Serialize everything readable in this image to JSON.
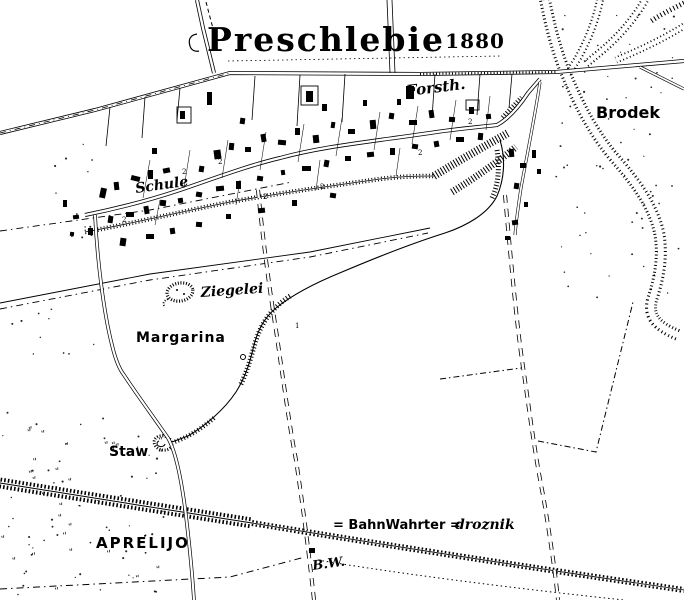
{
  "map": {
    "title": "Preschlebie",
    "year": "- 1880",
    "labels": {
      "forsth": "Forsth.",
      "brodek": "Brodek",
      "schule": "Schule",
      "ziegelei": "Ziegelei",
      "margarina": "Margarina",
      "staw": "Staw",
      "aprelijo": "APRELIJO",
      "bw_abbrev": "B.W."
    },
    "legend": {
      "equals_left": "= BahnWahrter =",
      "term_right": "droznik"
    },
    "colors": {
      "ink": "#000000",
      "paper": "#ffffff"
    },
    "parcel_marks": [
      [
        "2",
        122,
        222
      ],
      [
        "2",
        218,
        164
      ],
      [
        "2",
        263,
        199
      ],
      [
        "2",
        320,
        189
      ],
      [
        "2",
        418,
        155
      ],
      [
        "2",
        468,
        124
      ],
      [
        "2",
        182,
        174
      ],
      [
        "1",
        295,
        328
      ]
    ],
    "buildings": [
      [
        100,
        188,
        6,
        10,
        12
      ],
      [
        114,
        182,
        5,
        8,
        -6
      ],
      [
        131,
        176,
        9,
        5,
        14
      ],
      [
        148,
        170,
        5,
        9,
        0
      ],
      [
        163,
        168,
        7,
        5,
        -12
      ],
      [
        199,
        166,
        5,
        6,
        9
      ],
      [
        214,
        150,
        7,
        9,
        -8
      ],
      [
        229,
        143,
        5,
        7,
        6
      ],
      [
        245,
        147,
        6,
        5,
        0
      ],
      [
        261,
        134,
        5,
        8,
        -10
      ],
      [
        278,
        140,
        8,
        5,
        5
      ],
      [
        295,
        128,
        5,
        7,
        0
      ],
      [
        313,
        135,
        6,
        8,
        -6
      ],
      [
        331,
        122,
        4,
        6,
        8
      ],
      [
        348,
        129,
        7,
        5,
        0
      ],
      [
        370,
        120,
        6,
        9,
        -5
      ],
      [
        389,
        113,
        5,
        6,
        8
      ],
      [
        409,
        120,
        8,
        5,
        0
      ],
      [
        429,
        110,
        5,
        8,
        -8
      ],
      [
        449,
        117,
        6,
        5,
        5
      ],
      [
        469,
        107,
        5,
        7,
        0
      ],
      [
        486,
        114,
        5,
        5,
        -6
      ],
      [
        152,
        148,
        5,
        6,
        0
      ],
      [
        207,
        92,
        5,
        13,
        0
      ],
      [
        240,
        118,
        5,
        6,
        8
      ],
      [
        322,
        104,
        5,
        7,
        0
      ],
      [
        363,
        100,
        4,
        6,
        0
      ],
      [
        180,
        111,
        5,
        8,
        0
      ],
      [
        306,
        91,
        7,
        11,
        0
      ],
      [
        406,
        86,
        8,
        13,
        0
      ],
      [
        397,
        99,
        4,
        6,
        0
      ],
      [
        108,
        216,
        5,
        7,
        8
      ],
      [
        126,
        212,
        8,
        5,
        0
      ],
      [
        144,
        206,
        5,
        8,
        -10
      ],
      [
        160,
        200,
        6,
        6,
        6
      ],
      [
        178,
        198,
        5,
        5,
        -8
      ],
      [
        196,
        192,
        6,
        5,
        10
      ],
      [
        216,
        186,
        8,
        5,
        -5
      ],
      [
        236,
        181,
        5,
        8,
        0
      ],
      [
        257,
        176,
        6,
        5,
        8
      ],
      [
        281,
        170,
        4,
        5,
        -8
      ],
      [
        302,
        166,
        9,
        5,
        0
      ],
      [
        324,
        160,
        5,
        7,
        10
      ],
      [
        345,
        156,
        6,
        5,
        0
      ],
      [
        367,
        152,
        7,
        5,
        -6
      ],
      [
        390,
        148,
        5,
        7,
        0
      ],
      [
        412,
        144,
        6,
        5,
        8
      ],
      [
        434,
        141,
        5,
        6,
        -10
      ],
      [
        456,
        137,
        8,
        5,
        0
      ],
      [
        478,
        133,
        5,
        7,
        5
      ],
      [
        120,
        238,
        6,
        8,
        8
      ],
      [
        146,
        234,
        8,
        5,
        0
      ],
      [
        170,
        228,
        5,
        6,
        -8
      ],
      [
        196,
        222,
        6,
        5,
        5
      ],
      [
        226,
        214,
        5,
        5,
        0
      ],
      [
        258,
        208,
        7,
        5,
        -6
      ],
      [
        292,
        200,
        5,
        6,
        0
      ],
      [
        330,
        193,
        6,
        5,
        8
      ],
      [
        63,
        200,
        4,
        7,
        0
      ],
      [
        73,
        215,
        6,
        4,
        -8
      ],
      [
        70,
        232,
        4,
        4,
        6
      ],
      [
        88,
        228,
        5,
        7,
        0
      ],
      [
        509,
        149,
        5,
        8,
        -5
      ],
      [
        520,
        163,
        6,
        5,
        0
      ],
      [
        514,
        183,
        5,
        6,
        8
      ],
      [
        524,
        202,
        4,
        5,
        0
      ],
      [
        512,
        220,
        6,
        5,
        -8
      ],
      [
        532,
        150,
        4,
        8,
        0
      ],
      [
        537,
        169,
        4,
        5,
        0
      ],
      [
        505,
        236,
        5,
        4,
        0
      ],
      [
        309,
        548,
        6,
        5,
        0
      ]
    ]
  }
}
